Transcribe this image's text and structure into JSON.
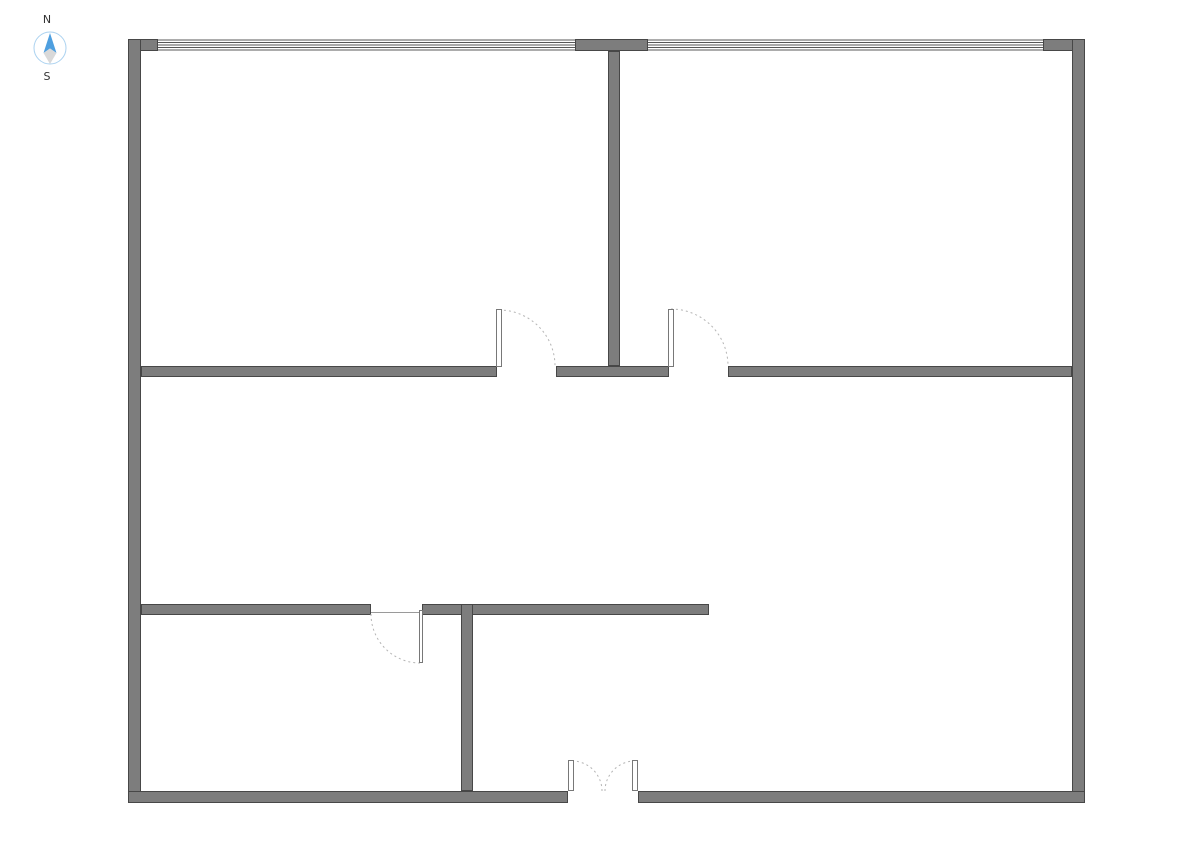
{
  "compass": {
    "north_label": "N",
    "south_label": "S",
    "label_color": "#333333",
    "ring_color": "#abd2f0",
    "north_arrow_color": "#4e9fdf",
    "south_arrow_color": "#d9d9d9"
  },
  "floorplan": {
    "colors": {
      "background": "#ffffff",
      "wall_fill": "#7d7d7d",
      "wall_stroke": "#474747",
      "window_line": "#585858",
      "door_leaf_fill": "#ffffff",
      "door_leaf_stroke": "#787878",
      "door_arc": "#b5b5b5",
      "threshold_line": "#9a9a9a"
    },
    "walls": [
      {
        "name": "exterior-top-wall-left-segment",
        "x": 128,
        "y": 39,
        "w": 30,
        "h": 12
      },
      {
        "name": "exterior-top-wall-center-segment",
        "x": 575,
        "y": 39,
        "w": 73,
        "h": 12
      },
      {
        "name": "exterior-top-wall-right-segment",
        "x": 1043,
        "y": 39,
        "w": 42,
        "h": 12
      },
      {
        "name": "exterior-left-wall",
        "x": 128,
        "y": 39,
        "w": 13,
        "h": 764
      },
      {
        "name": "exterior-right-wall",
        "x": 1072,
        "y": 39,
        "w": 13,
        "h": 764
      },
      {
        "name": "exterior-bottom-wall-left-segment",
        "x": 128,
        "y": 791,
        "w": 440,
        "h": 12
      },
      {
        "name": "exterior-bottom-wall-right-segment",
        "x": 638,
        "y": 791,
        "w": 447,
        "h": 12
      },
      {
        "name": "upper-rooms-divider-wall",
        "x": 608,
        "y": 51,
        "w": 12,
        "h": 315
      },
      {
        "name": "middle-wall-left-segment",
        "x": 141,
        "y": 366,
        "w": 356,
        "h": 11
      },
      {
        "name": "middle-wall-center-segment",
        "x": 556,
        "y": 366,
        "w": 113,
        "h": 11
      },
      {
        "name": "middle-wall-right-segment",
        "x": 728,
        "y": 366,
        "w": 344,
        "h": 11
      },
      {
        "name": "lower-wall-left-segment",
        "x": 141,
        "y": 604,
        "w": 230,
        "h": 11
      },
      {
        "name": "lower-wall-right-segment",
        "x": 422,
        "y": 604,
        "w": 287,
        "h": 11
      },
      {
        "name": "lower-rooms-divider-wall",
        "x": 461,
        "y": 604,
        "w": 12,
        "h": 187
      }
    ],
    "windows": [
      {
        "name": "top-window-left",
        "x": 158,
        "y": 39,
        "w": 417,
        "h": 12,
        "lines": 5
      },
      {
        "name": "top-window-right",
        "x": 648,
        "y": 39,
        "w": 395,
        "h": 12,
        "lines": 5
      }
    ],
    "threshold_lines": [
      {
        "name": "lower-left-door-threshold",
        "x1": 371,
        "y1": 612.5,
        "x2": 422,
        "y2": 612.5
      }
    ],
    "door_arcs": [
      {
        "name": "upper-left-door-swing-arc",
        "d": "M 499 310 A 56 56 0 0 1 555 366"
      },
      {
        "name": "upper-right-door-swing-arc",
        "d": "M 671 309 A 57 57 0 0 1 728 366"
      },
      {
        "name": "lower-left-door-swing-arc",
        "d": "M 371 614 A 49 49 0 0 0 420 663"
      },
      {
        "name": "double-door-left-swing-arc",
        "d": "M 572 761 A 30 30 0 0 1 602 791"
      },
      {
        "name": "double-door-right-swing-arc",
        "d": "M 635 761 A 30 30 0 0 0 605 791"
      }
    ],
    "door_leaves": [
      {
        "name": "upper-left-door-leaf",
        "x": 496,
        "y": 309,
        "w": 6,
        "h": 58
      },
      {
        "name": "upper-right-door-leaf",
        "x": 668,
        "y": 309,
        "w": 6,
        "h": 58
      },
      {
        "name": "lower-left-door-leaf",
        "x": 419,
        "y": 610,
        "w": 4,
        "h": 53
      },
      {
        "name": "double-door-left-leaf",
        "x": 568,
        "y": 760,
        "w": 6,
        "h": 31
      },
      {
        "name": "double-door-right-leaf",
        "x": 632,
        "y": 760,
        "w": 6,
        "h": 31
      }
    ]
  }
}
